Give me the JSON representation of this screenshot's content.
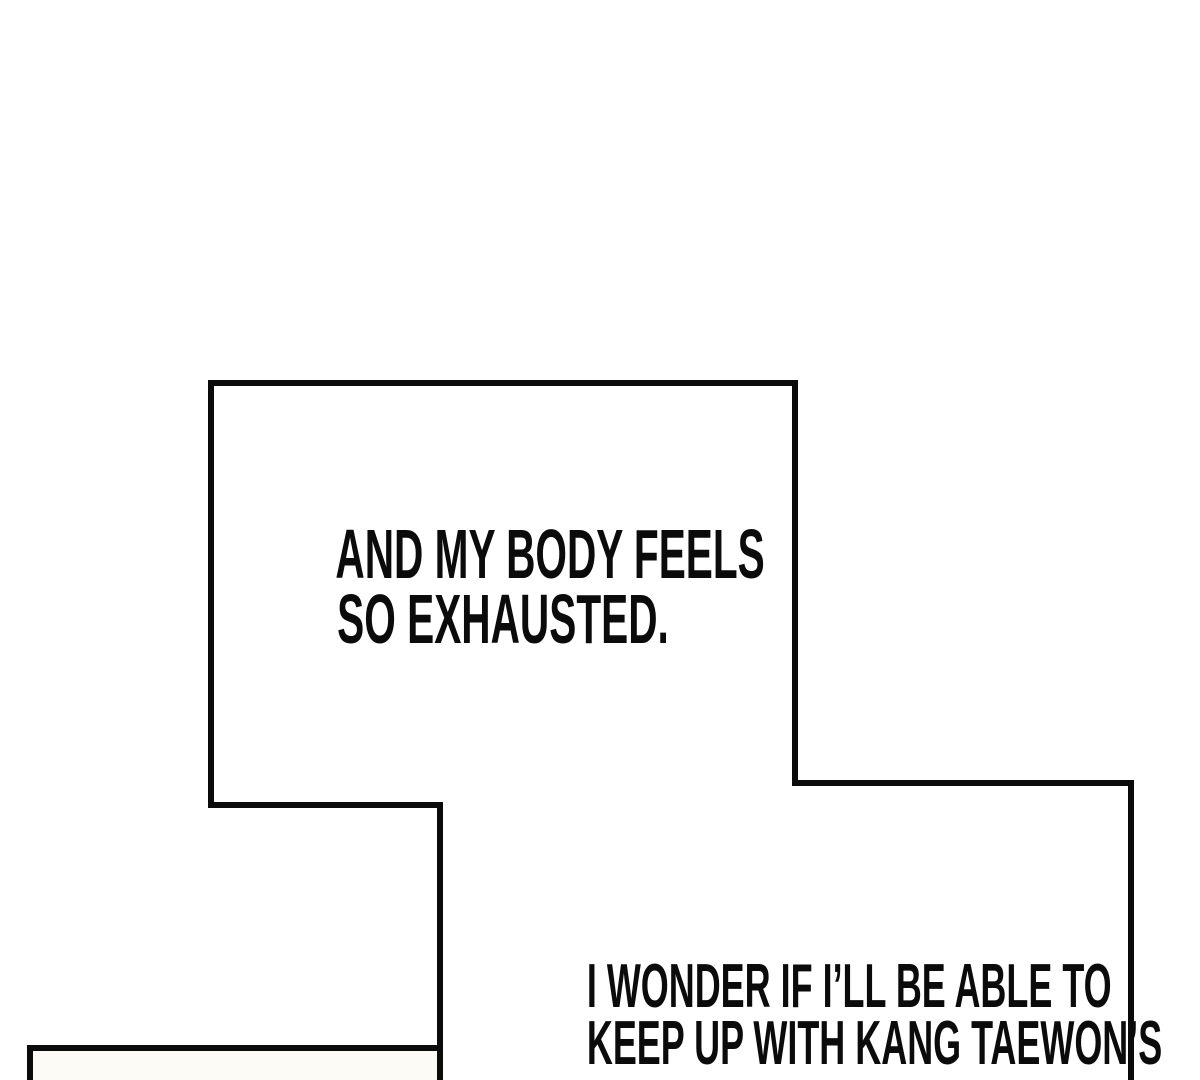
{
  "page": {
    "type": "webtoon-comic-panel-fragment"
  },
  "colors": {
    "paper": "#ffffff",
    "ink": "#0b0b0b",
    "panel-tint": "#fdfbf6"
  },
  "captions": [
    {
      "id": "caption-exhausted",
      "lines": [
        "AND MY BODY FEELS",
        "SO EXHAUSTED."
      ]
    },
    {
      "id": "caption-wonder",
      "lines": [
        "I WONDER IF I’LL BE ABLE TO",
        "KEEP UP WITH KANG TAEWON’S"
      ]
    }
  ]
}
